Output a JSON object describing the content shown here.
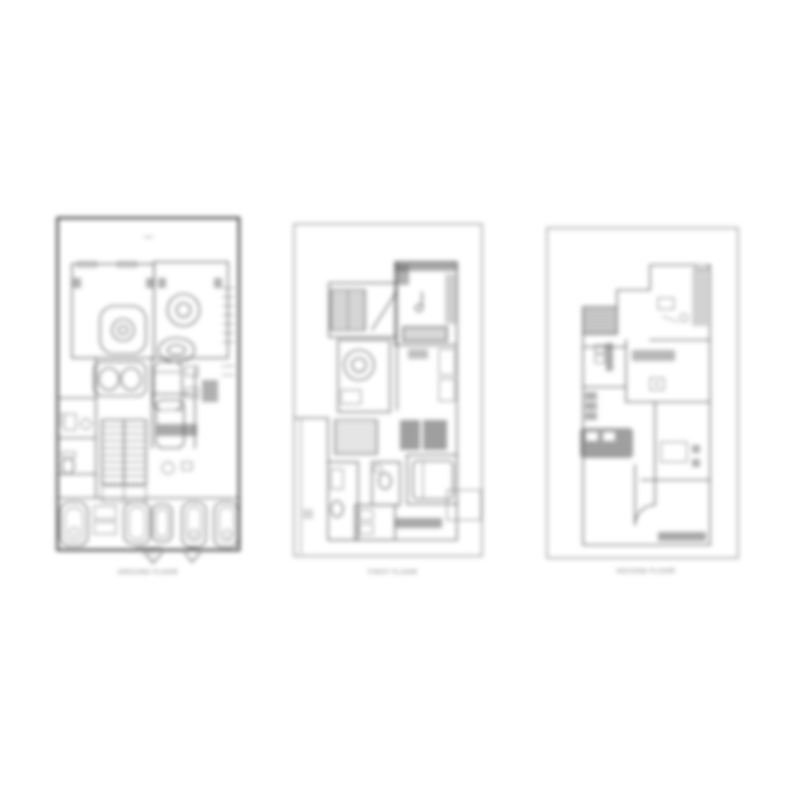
{
  "page": {
    "background": "#ffffff"
  },
  "colors": {
    "line": "#474747",
    "line_light": "#7d7d7d",
    "fill_dark": "#5f5f5f",
    "border_dark": "#3a3a3a",
    "border_light": "#8a8a8a",
    "caption_text": "#6a6a6a"
  },
  "panels": [
    {
      "id": "plan-1",
      "caption": "GROUND FLOOR",
      "scale_note": "1:100"
    },
    {
      "id": "plan-2",
      "caption": "FIRST FLOOR"
    },
    {
      "id": "plan-3",
      "caption": "SECOND FLOOR"
    }
  ]
}
